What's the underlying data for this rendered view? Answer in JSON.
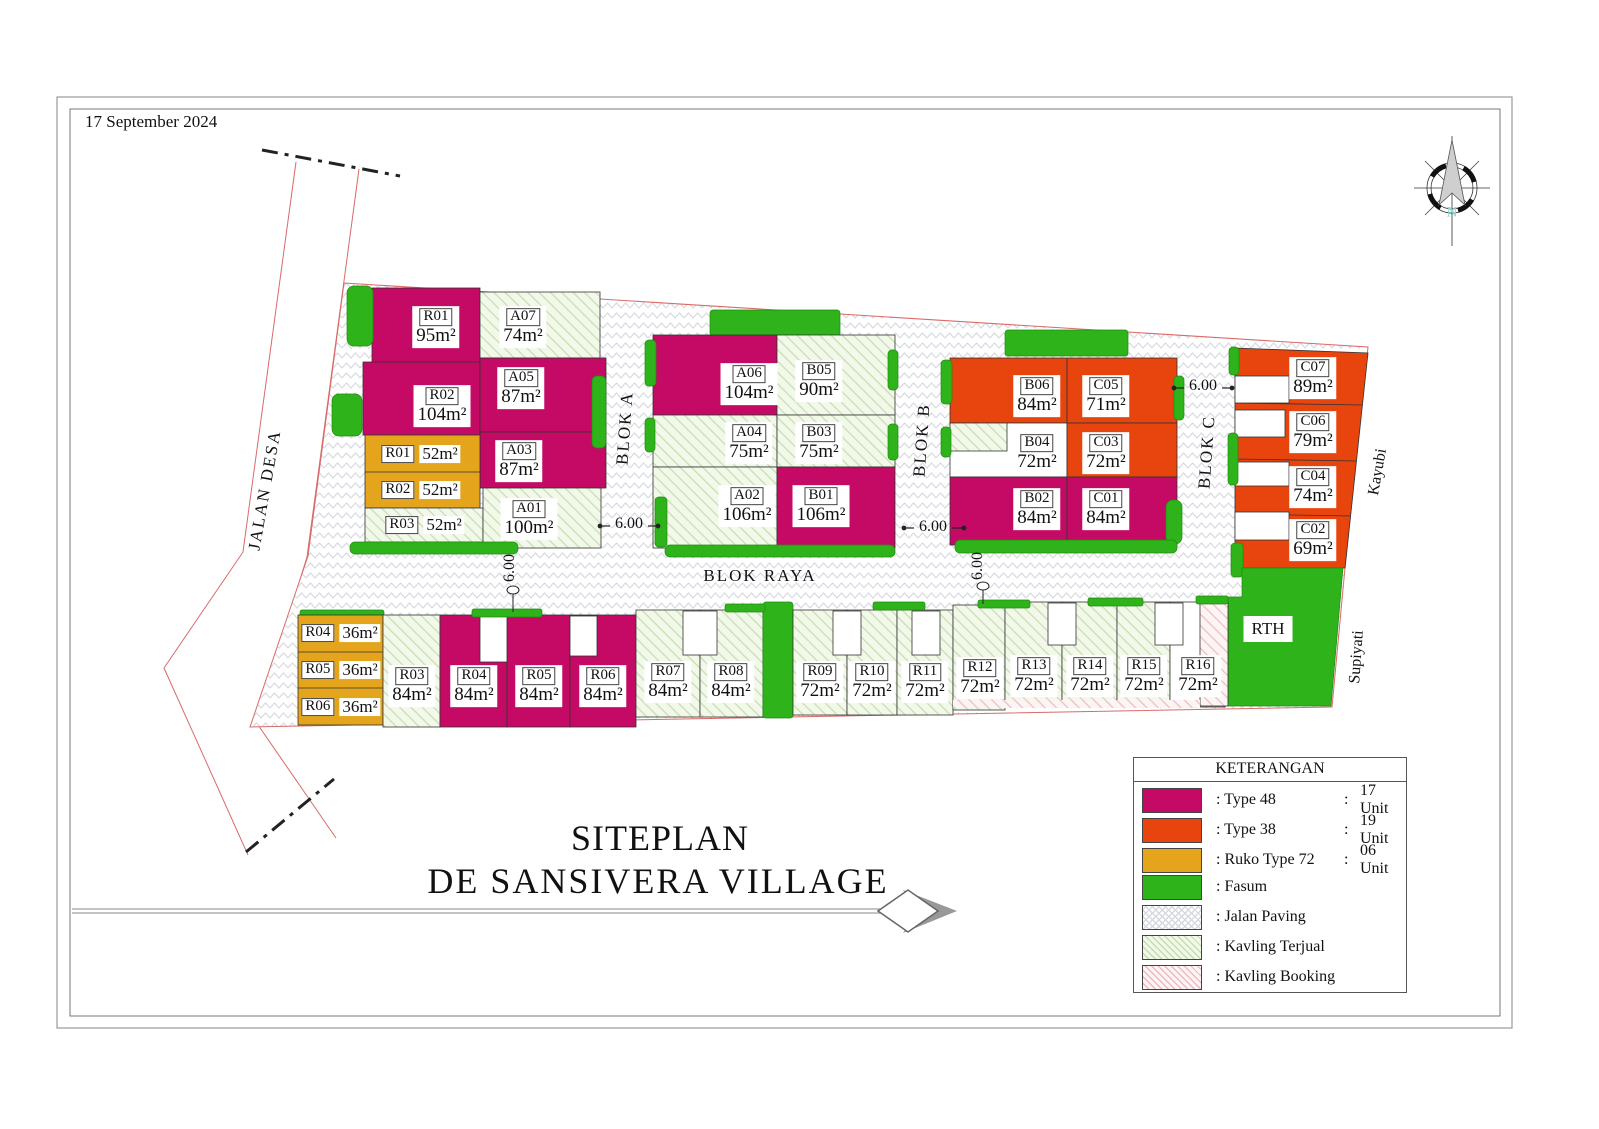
{
  "page": {
    "date": "17 September 2024"
  },
  "title": {
    "line1": "SITEPLAN",
    "line2": "DE SANSIVERA VILLAGE"
  },
  "compass": {
    "north": "N"
  },
  "labels": {
    "jalan_desa": "JALAN DESA",
    "blok_raya": "BLOK RAYA",
    "blok_a": "BLOK A",
    "blok_b": "BLOK B",
    "blok_c": "BLOK C",
    "kayubi": "Kayubi",
    "supiyati": "Supiyati",
    "rth": "RTH",
    "dim": "6.00"
  },
  "colors": {
    "type48": "#C40A64",
    "type38": "#E8440D",
    "ruko": "#E4A41C",
    "fasum": "#2FB31A"
  },
  "units": {
    "rh1": {
      "code": "R01",
      "area": "95m²"
    },
    "rh2": {
      "code": "R02",
      "area": "104m²"
    },
    "a07": {
      "code": "A07",
      "area": "74m²"
    },
    "a05": {
      "code": "A05",
      "area": "87m²"
    },
    "a03": {
      "code": "A03",
      "area": "87m²"
    },
    "a01": {
      "code": "A01",
      "area": "100m²"
    },
    "rk1": {
      "code": "R01",
      "area": "52m²"
    },
    "rk2": {
      "code": "R02",
      "area": "52m²"
    },
    "rk3": {
      "code": "R03",
      "area": "52m²"
    },
    "a06": {
      "code": "A06",
      "area": "104m²"
    },
    "b05": {
      "code": "B05",
      "area": "90m²"
    },
    "a04": {
      "code": "A04",
      "area": "75m²"
    },
    "b03": {
      "code": "B03",
      "area": "75m²"
    },
    "a02": {
      "code": "A02",
      "area": "106m²"
    },
    "b01": {
      "code": "B01",
      "area": "106m²"
    },
    "b06": {
      "code": "B06",
      "area": "84m²"
    },
    "c05": {
      "code": "C05",
      "area": "71m²"
    },
    "b04": {
      "code": "B04",
      "area": "72m²"
    },
    "c03": {
      "code": "C03",
      "area": "72m²"
    },
    "b02": {
      "code": "B02",
      "area": "84m²"
    },
    "c01": {
      "code": "C01",
      "area": "84m²"
    },
    "c07": {
      "code": "C07",
      "area": "89m²"
    },
    "c06": {
      "code": "C06",
      "area": "79m²"
    },
    "c04": {
      "code": "C04",
      "area": "74m²"
    },
    "c02": {
      "code": "C02",
      "area": "69m²"
    },
    "rk4": {
      "code": "R04",
      "area": "36m²"
    },
    "rk5": {
      "code": "R05",
      "area": "36m²"
    },
    "rk6": {
      "code": "R06",
      "area": "36m²"
    },
    "rb03": {
      "code": "R03",
      "area": "84m²"
    },
    "rb04": {
      "code": "R04",
      "area": "84m²"
    },
    "rb05": {
      "code": "R05",
      "area": "84m²"
    },
    "rb06": {
      "code": "R06",
      "area": "84m²"
    },
    "rb07": {
      "code": "R07",
      "area": "84m²"
    },
    "rb08": {
      "code": "R08",
      "area": "84m²"
    },
    "rb09": {
      "code": "R09",
      "area": "72m²"
    },
    "rb10": {
      "code": "R10",
      "area": "72m²"
    },
    "rb11": {
      "code": "R11",
      "area": "72m²"
    },
    "rb12": {
      "code": "R12",
      "area": "72m²"
    },
    "rb13": {
      "code": "R13",
      "area": "72m²"
    },
    "rb14": {
      "code": "R14",
      "area": "72m²"
    },
    "rb15": {
      "code": "R15",
      "area": "72m²"
    },
    "rb16": {
      "code": "R16",
      "area": "72m²"
    }
  },
  "legend": {
    "title": "KETERANGAN",
    "items": [
      {
        "label": ": Type 48",
        "sep": ":",
        "count": "17 Unit"
      },
      {
        "label": ": Type 38",
        "sep": ":",
        "count": "19 Unit"
      },
      {
        "label": ": Ruko Type 72",
        "sep": ":",
        "count": "06 Unit"
      },
      {
        "label": ": Fasum",
        "sep": "",
        "count": ""
      },
      {
        "label": ": Jalan Paving",
        "sep": "",
        "count": ""
      },
      {
        "label": ": Kavling Terjual",
        "sep": "",
        "count": ""
      },
      {
        "label": ": Kavling Booking",
        "sep": "",
        "count": ""
      }
    ]
  }
}
